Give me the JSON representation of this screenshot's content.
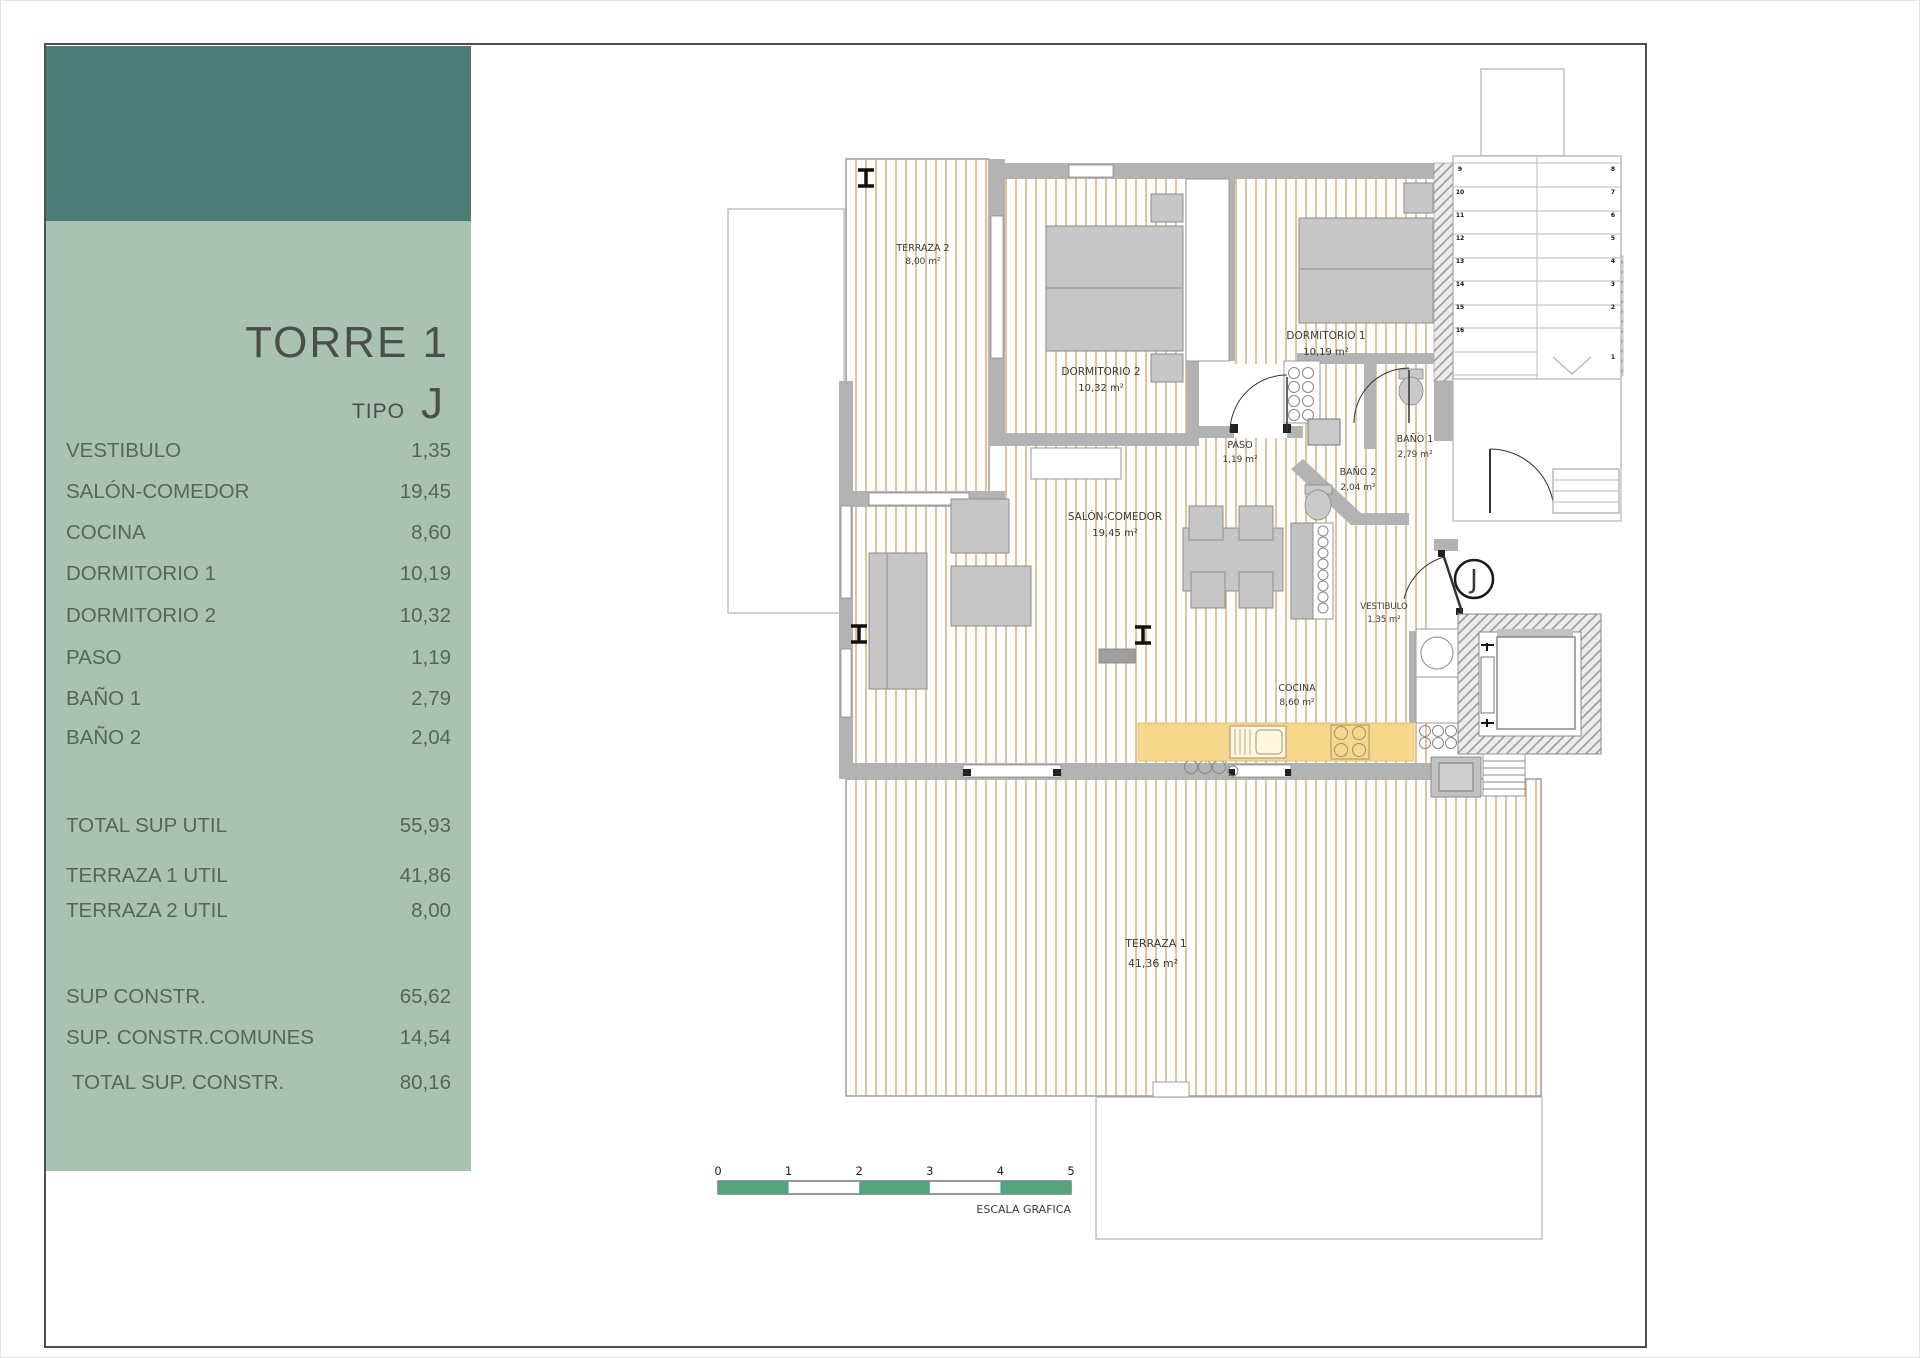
{
  "colors": {
    "header_teal": "#4d7d79",
    "panel_green": "#a9c2b2",
    "scale_green": "#55a47d",
    "wall_gray": "#b3b3b3",
    "deck_stripe": "#c79d69",
    "kitchen_counter": "#f7d78c"
  },
  "sidebar": {
    "title": "TORRE 1",
    "tipo_label": "TIPO",
    "tipo_value": "J",
    "rooms": [
      {
        "label": "VESTIBULO",
        "value": "1,35"
      },
      {
        "label": "SALÓN-COMEDOR",
        "value": "19,45"
      },
      {
        "label": "COCINA",
        "value": "8,60"
      },
      {
        "label": "DORMITORIO 1",
        "value": "10,19"
      },
      {
        "label": "DORMITORIO 2",
        "value": "10,32"
      },
      {
        "label": "PASO",
        "value": "1,19"
      },
      {
        "label": "BAÑO 1",
        "value": "2,79"
      },
      {
        "label": "BAÑO 2",
        "value": "2,04"
      }
    ],
    "totals": [
      {
        "label": "TOTAL SUP UTIL",
        "value": "55,93"
      },
      {
        "label": "TERRAZA 1 UTIL",
        "value": "41,86"
      },
      {
        "label": "TERRAZA 2 UTIL",
        "value": "8,00"
      }
    ],
    "constructed": [
      {
        "label": "SUP CONSTR.",
        "value": "65,62"
      },
      {
        "label": "SUP. CONSTR.COMUNES",
        "value": "14,54"
      },
      {
        "label": "TOTAL SUP. CONSTR.",
        "value": "80,16"
      }
    ]
  },
  "plan": {
    "rooms": {
      "terraza2": {
        "name": "TERRAZA 2",
        "area": "8,00 m²"
      },
      "dormitorio2": {
        "name": "DORMITORIO 2",
        "area": "10,32 m²"
      },
      "dormitorio1": {
        "name": "DORMITORIO 1",
        "area": "10,19 m²"
      },
      "paso": {
        "name": "PASO",
        "area": "1,19 m²"
      },
      "bano1": {
        "name": "BAÑO 1",
        "area": "2,79 m²"
      },
      "bano2": {
        "name": "BAÑO 2",
        "area": "2,04 m²"
      },
      "salon": {
        "name": "SALÓN-COMEDOR",
        "area": "19,45 m²"
      },
      "vestibulo": {
        "name": "VESTIBULO",
        "area": "1,35 m²"
      },
      "cocina": {
        "name": "COCINA",
        "area": "8,60 m²"
      },
      "terraza1": {
        "name": "TERRAZA 1",
        "area": "41,36 m²"
      }
    },
    "unit_marker": "J",
    "stair_left": [
      "9",
      "10",
      "11",
      "12",
      "13",
      "14",
      "15",
      "16"
    ],
    "stair_right": [
      "8",
      "7",
      "6",
      "5",
      "4",
      "3",
      "2",
      "1"
    ]
  },
  "scale_bar": {
    "ticks": [
      "0",
      "1",
      "2",
      "3",
      "4",
      "5"
    ],
    "label": "ESCALA GRAFICA"
  }
}
